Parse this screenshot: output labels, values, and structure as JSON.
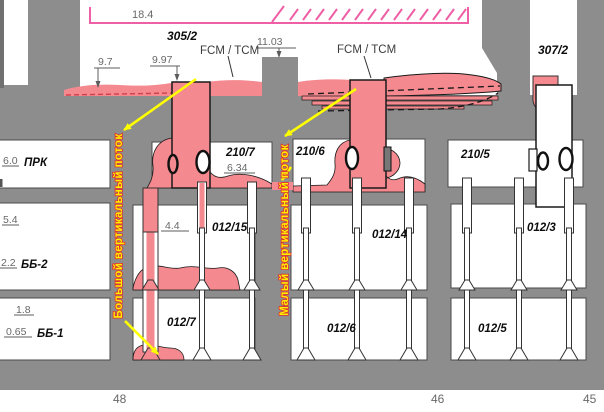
{
  "dimensions": {
    "top_width": "18.4",
    "top_pillar": "11.03",
    "roof_left": "9.7",
    "roof_mid": "9.97",
    "shaft_depth": "6.34",
    "borehole_joint": "4.4"
  },
  "left_scale": {
    "prk_value": "6.0",
    "prk_label": "ПРК",
    "mid_value": "5.4",
    "bb2_value": "2.2",
    "bb2_label": "ББ-2",
    "low_value": "1.8",
    "bb1_value": "0.65",
    "bb1_label": "ББ-1"
  },
  "chambers": {
    "c305": "305/2",
    "c307": "307/2",
    "c2107": "210/7",
    "c2106": "210/6",
    "c2105": "210/5",
    "c01215": "012/15",
    "c01214": "012/14",
    "c0123": "012/3",
    "c0127": "012/7",
    "c0126": "012/6",
    "c0125": "012/5"
  },
  "flow_labels": {
    "fcm_tcm_left": "FCM / TCM",
    "fcm_tcm_right": "FCM / TCM",
    "big_flow": "Большой вертикальный поток",
    "small_flow": "Малый вертикальный поток"
  },
  "axis": {
    "p48": "48",
    "p46": "46",
    "p45": "45"
  },
  "colors": {
    "massif_gray": "#8d8d8d",
    "brine_pink": "#f4898f",
    "hatch_pink": "#ee5fa5",
    "arrow_yellow": "#ffff00",
    "flow_text_fill": "#ffee00",
    "flow_text_stroke": "#e03030",
    "dashed_red": "#d04048"
  }
}
